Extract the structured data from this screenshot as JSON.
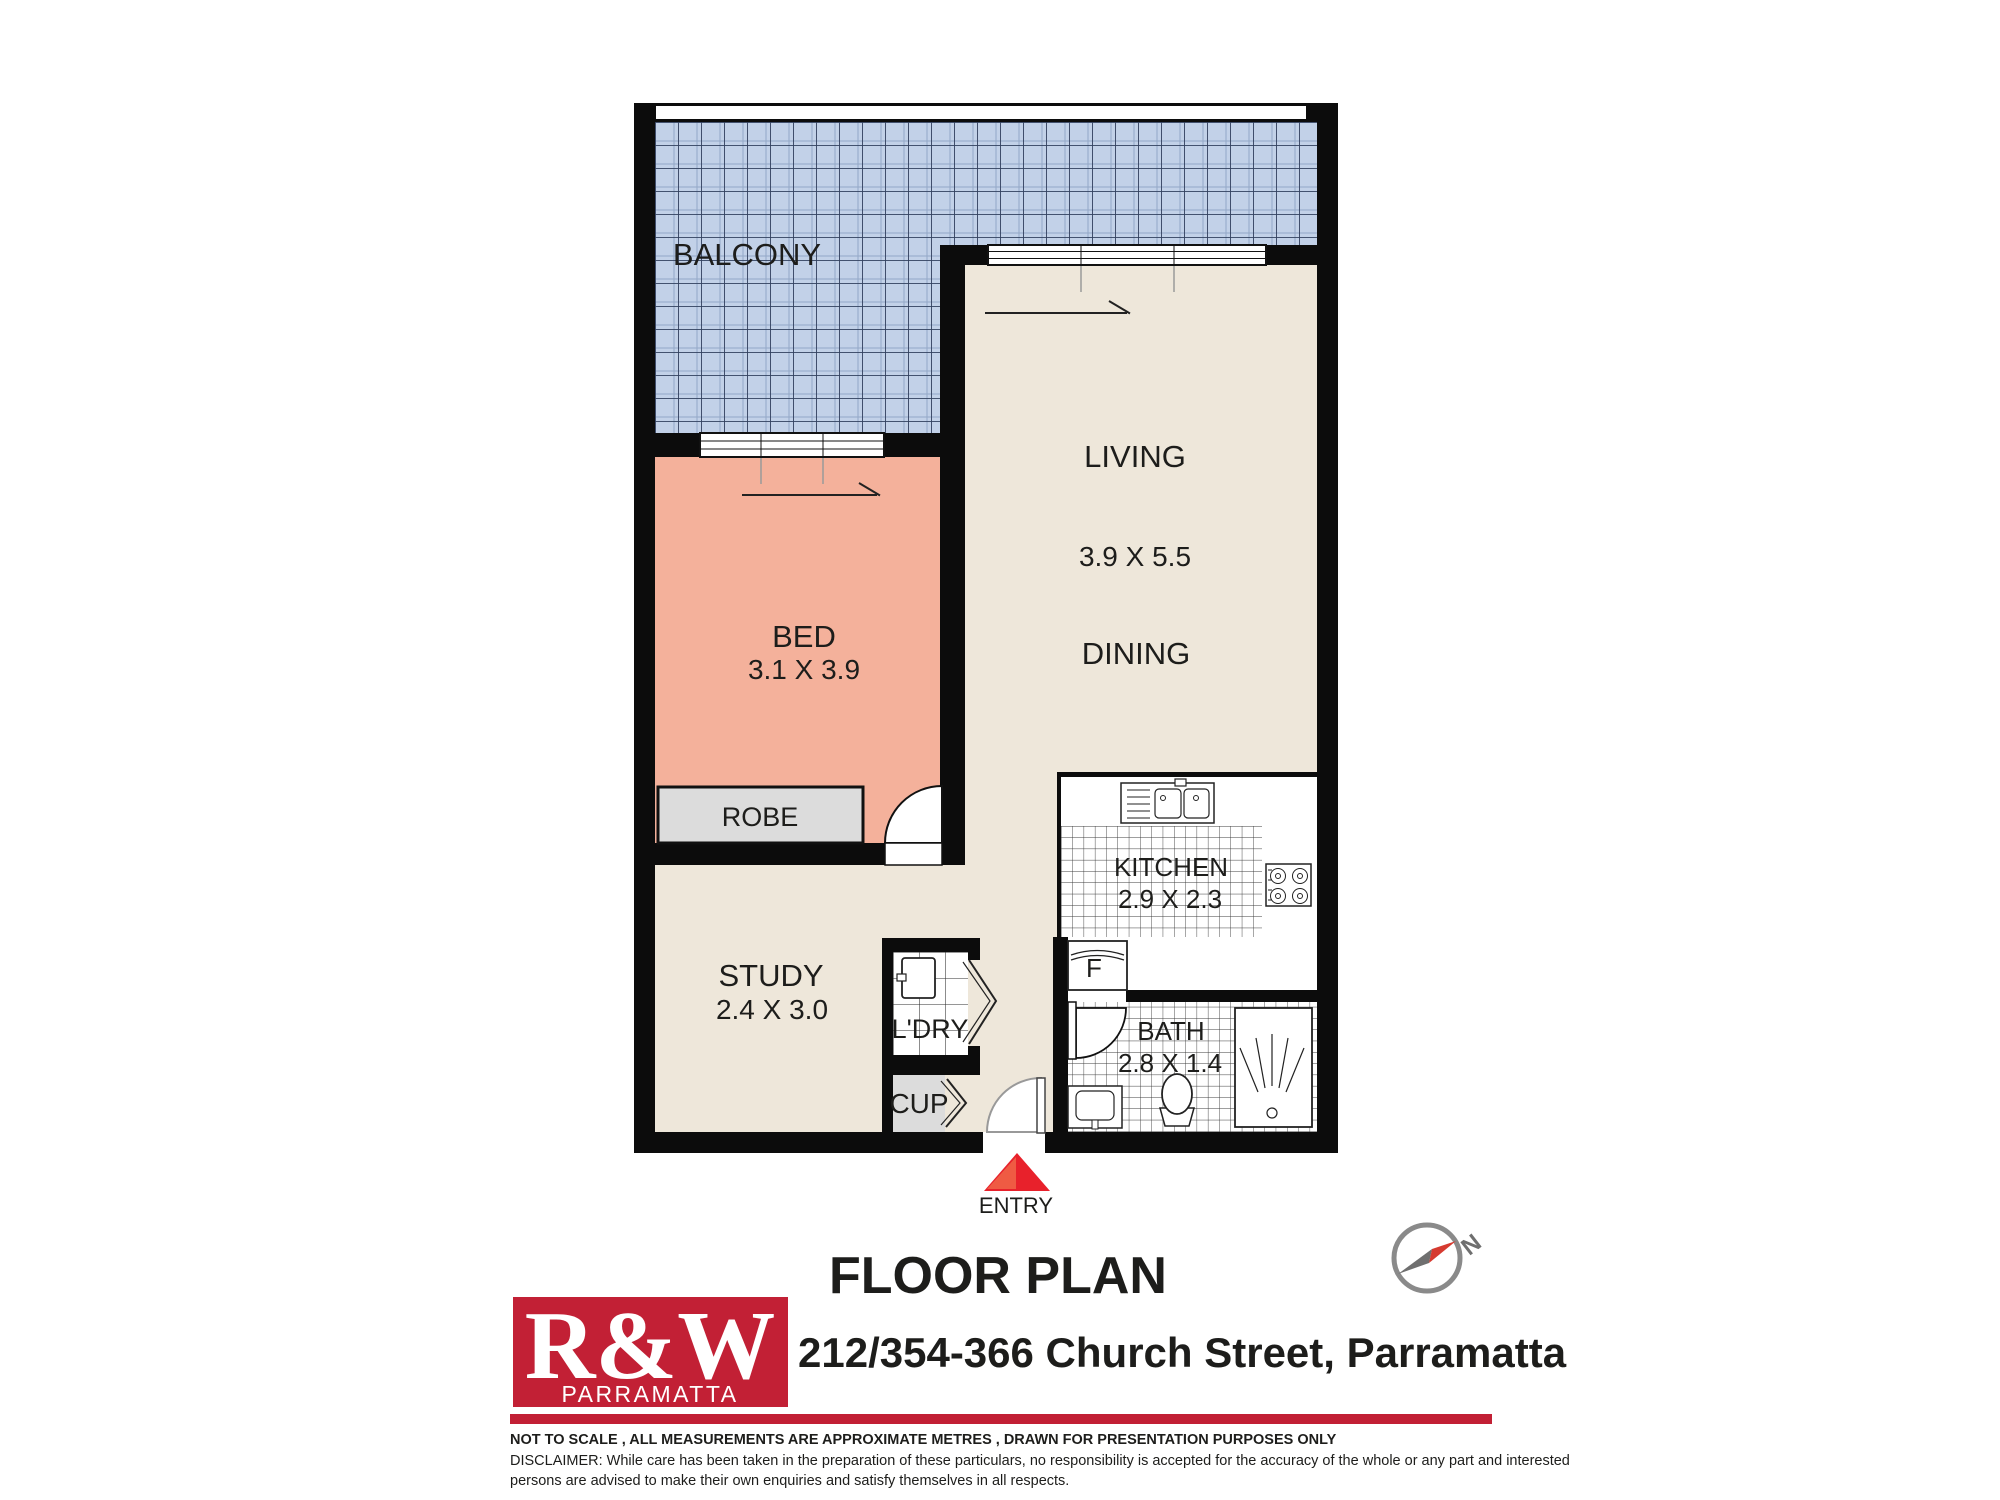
{
  "plan": {
    "balcony_label": "BALCONY",
    "living_label": "LIVING",
    "living_dims": "3.9 X 5.5",
    "dining_label": "DINING",
    "bed_label": "BED",
    "bed_dims": "3.1 X 3.9",
    "robe_label": "ROBE",
    "study_label": "STUDY",
    "study_dims": "2.4 X 3.0",
    "laundry_label": "L'DRY",
    "cupboard_label": "CUP",
    "kitchen_label": "KITCHEN",
    "kitchen_dims": "2.9 X 2.3",
    "fridge_label": "F",
    "bath_label": "BATH",
    "bath_dims": "2.8 X 1.4",
    "entry_label": "ENTRY",
    "compass_north": "N"
  },
  "footer": {
    "title": "FLOOR PLAN",
    "address": "212/354-366 Church Street, Parramatta",
    "logo_brand": "R&W",
    "logo_office": "PARRAMATTA",
    "disclaimer_line1": "NOT TO SCALE , ALL MEASUREMENTS ARE APPROXIMATE METRES , DRAWN FOR PRESENTATION PURPOSES ONLY",
    "disclaimer_line2": "DISCLAIMER:  While care has been taken in the preparation of these particulars, no responsibility is accepted for the accuracy of the whole or any part and interested",
    "disclaimer_line3": "persons are advised to make their own enquiries and satisfy  themselves in all respects."
  },
  "colors": {
    "wall": "#0c0c0c",
    "floor_beige": "#eee7da",
    "balcony_blue": "#c2d1e8",
    "balcony_grid": "#31405e",
    "bed_salmon": "#f4b19b",
    "storage_gray": "#dcdcdc",
    "entry_red": "#e8212b",
    "brand_red": "#c22035",
    "compass_gray": "#8a8a8a",
    "compass_red": "#d63a30"
  }
}
